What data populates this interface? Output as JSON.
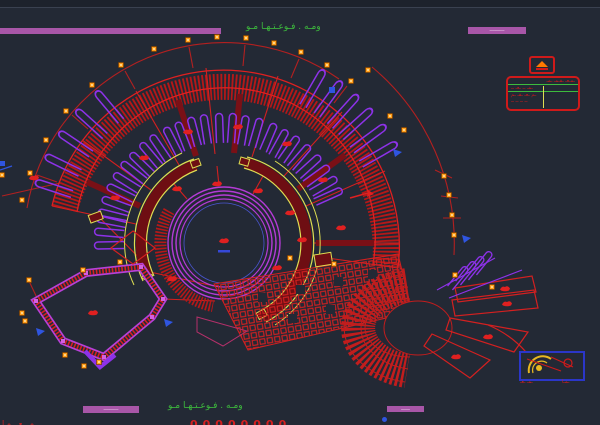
{
  "canvas": {
    "app_type": "cad-drawing-viewport",
    "bg": "#232935",
    "top_strip": "#1d222c"
  },
  "palette": {
    "red": "#d42020",
    "hatch_red": "#b51818",
    "dark_red_wall": "#6e0e13",
    "purple_stacks": "#8d32e8",
    "ring_magenta": "#b43bd6",
    "fan_magenta": "#b840d8",
    "yellow_trim": "#dede52",
    "annotation_green": "#3dbb3d",
    "grid_marker_orange": "#ff9e1b",
    "blue_marks": "#2f55e0",
    "header_bar_magenta": "#a856a8",
    "title_block_red": "#cf1a1a",
    "legend_border_blue": "#2b36c8",
    "legend_yellow": "#e8b820"
  },
  "header": {
    "title_annotation": "ومـه . فـوعـتـهـا مـو",
    "badge_text": "ــــــــــ"
  },
  "title_block": {
    "rows": [
      "ـمـعـ ـقـمـ ـمـ",
      "ـمـ ــ ـعـ ــ",
      "ـم ـعـ ـقـ ـم",
      "ــ ــ ــ ــ"
    ]
  },
  "legend": {
    "caption_left": "ـمـ ـعـ",
    "caption_right": "ـمـا"
  },
  "footer": {
    "annotation": "ومـه . فـوعـتـهـا مـو",
    "badge_left_text": "ــــــــــ",
    "badge_right_text": "ــــــ",
    "numbers_row": "00000000",
    "left_clipped_text": "ـمـ ـعـ ـمـا"
  }
}
